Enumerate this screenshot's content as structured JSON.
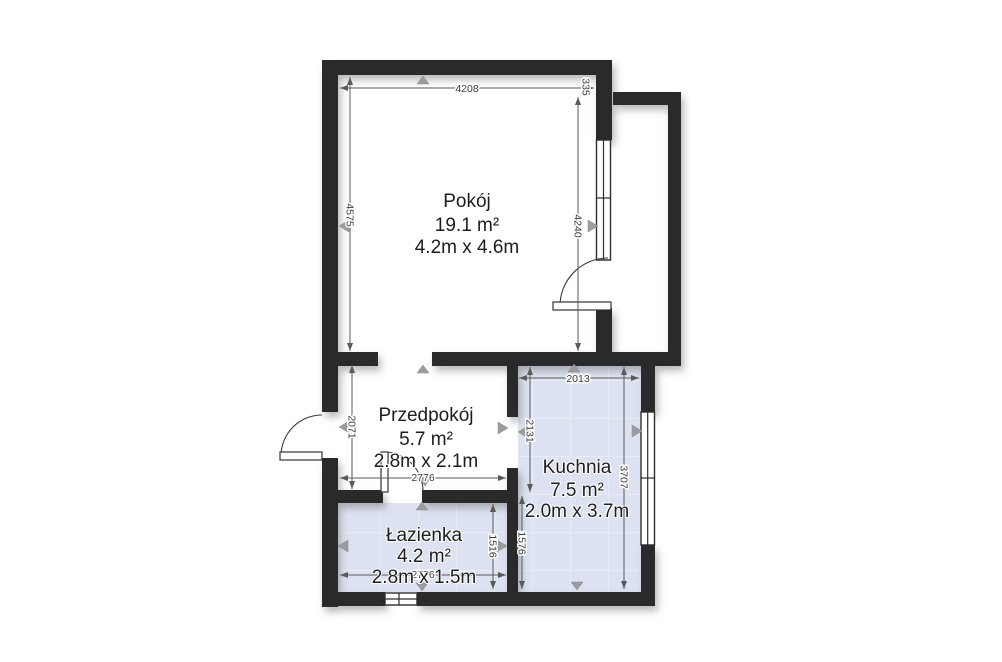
{
  "plan": {
    "rooms": [
      {
        "name": "Pokój",
        "area": "19.1 m²",
        "size": "4.2m x 4.6m"
      },
      {
        "name": "Przedpokój",
        "area": "5.7 m²",
        "size": "2.8m x 2.1m"
      },
      {
        "name": "Kuchnia",
        "area": "7.5 m²",
        "size": "2.0m x 3.7m"
      },
      {
        "name": "Łazienka",
        "area": "4.2 m²",
        "size": "2.8m x 1.5m"
      }
    ],
    "dimensions_mm": {
      "pokoj_top": "4208",
      "pokoj_left": "4575",
      "pokoj_right": "4240",
      "balcony_offset": "335",
      "przedpokoj_left": "2071",
      "przedpokoj_bottom": "2776",
      "kuchnia_top": "2013",
      "kuchnia_left_upper": "2131",
      "kuchnia_left_lower": "1576",
      "kuchnia_right": "3707",
      "lazienka_right": "1516",
      "lazienka_bottom": "2776"
    },
    "colors": {
      "wall": "#2b2b2b",
      "tile_fill": "#dce2f1",
      "tile_line": "#eaeef8",
      "dim_line": "#5a5a5a",
      "dim_text": "#3c3c3c",
      "room_text": "#1d1d1d",
      "marker": "#9c9c9c",
      "background": "#ffffff"
    }
  }
}
